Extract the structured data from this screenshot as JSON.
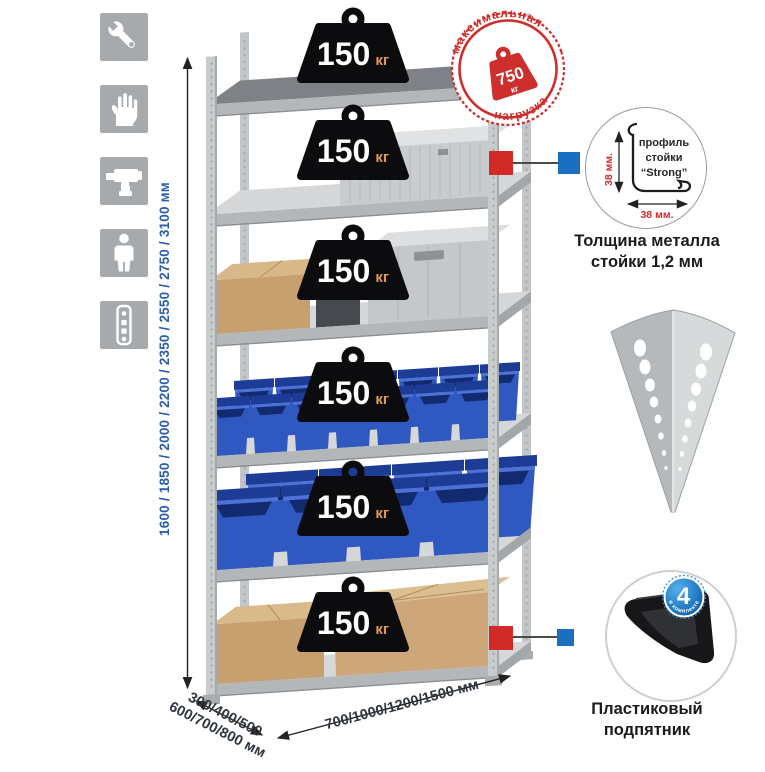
{
  "colors": {
    "accent_red": "#cd2f2c",
    "bin_blue": "#2f58c1",
    "badge_blue": "#0b63b0",
    "dimension_blue": "#2a5ea8",
    "icon_gray": "#a7aaad"
  },
  "left_icons": {
    "items": [
      {
        "icon": "wrench-icon"
      },
      {
        "icon": "gloves-icon"
      },
      {
        "icon": "drill-icon"
      },
      {
        "icon": "person-icon"
      },
      {
        "icon": "perforated-strip-icon"
      }
    ]
  },
  "height_dim": {
    "label": "1600 / 1850 / 2000 / 2200 / 2350 / 2550 / 2750 / 3100 мм"
  },
  "rack": {
    "weights": [
      {
        "value": "150",
        "unit": "кг"
      },
      {
        "value": "150",
        "unit": "кг"
      },
      {
        "value": "150",
        "unit": "кг"
      },
      {
        "value": "150",
        "unit": "кг"
      },
      {
        "value": "150",
        "unit": "кг"
      },
      {
        "value": "150",
        "unit": "кг"
      }
    ]
  },
  "stamp": {
    "arc_top": "максимальная",
    "arc_bottom": "нагрузка",
    "value": "750",
    "unit": "кг"
  },
  "profile": {
    "label_line1": "профиль",
    "label_line2": "стойки",
    "label_line3": "“Strong”",
    "dim_v": "38 мм.",
    "dim_h": "38 мм.",
    "caption1": "Толщина металла",
    "caption2": "стойки 1,2 мм"
  },
  "foot": {
    "badge_value": "4",
    "badge_text": "в комплекте",
    "caption1": "Пластиковый",
    "caption2": "подпятник"
  },
  "bottom_dims": {
    "depth1": "300/400/500",
    "depth2": "600/700/800 мм",
    "width": "700/1000/1200/1500 мм"
  }
}
